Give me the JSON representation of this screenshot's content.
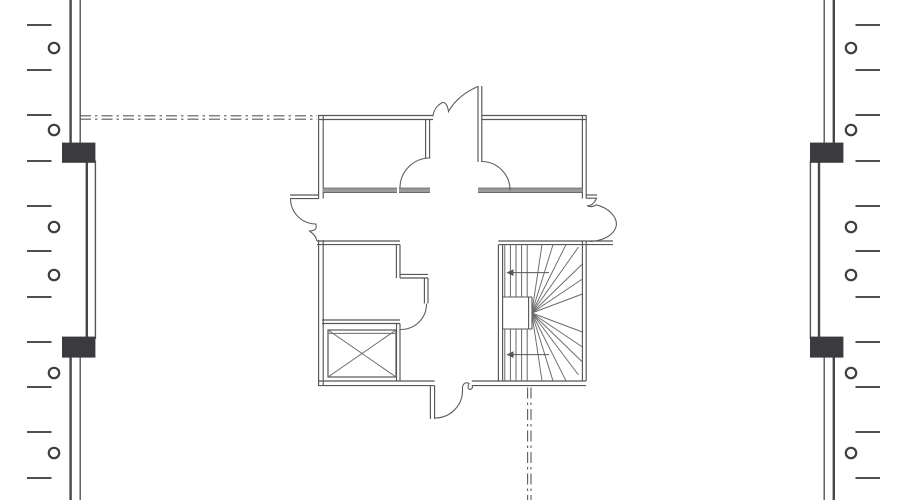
{
  "page": {
    "background": "#ffffff"
  },
  "colors": {
    "line": "#565656",
    "line_soft": "#6a6a6a",
    "thick_line": "#474747",
    "dark_block": "#3b3b3f",
    "wall_bar": "#9a9a9a"
  },
  "drawing": {
    "canvas": {
      "w": 900,
      "h": 500
    },
    "curtain_walls": [
      {
        "name": "left-curtain-wall",
        "segments": [
          {
            "xa": 70.6,
            "xb": 80.2,
            "y1": 0,
            "y2": 146
          },
          {
            "xa": 86.8,
            "xb": 95.4,
            "y1": 160.5,
            "y2": 339
          },
          {
            "xa": 70.6,
            "xb": 80.2,
            "y1": 356,
            "y2": 500
          }
        ],
        "blocks": [
          {
            "x": 62,
            "y": 142.6,
            "w": 33.4,
            "h": 20.2
          },
          {
            "x": 62,
            "y": 336.6,
            "w": 33.4,
            "h": 21
          }
        ],
        "ticks": {
          "x1": 27,
          "x2": 51.5,
          "ys": [
            25,
            70,
            115,
            161,
            206,
            251,
            297,
            342,
            387,
            432,
            478
          ]
        },
        "circles": {
          "cx": 54,
          "r": 5.2,
          "cys": [
            48,
            130,
            227,
            275,
            373,
            453
          ]
        }
      },
      {
        "name": "right-curtain-wall",
        "segments": [
          {
            "xa": 833.8,
            "xb": 824.2,
            "y1": 0,
            "y2": 146
          },
          {
            "xa": 819,
            "xb": 810.4,
            "y1": 160.5,
            "y2": 339
          },
          {
            "xa": 833.8,
            "xb": 824.2,
            "y1": 356,
            "y2": 500
          }
        ],
        "blocks": [
          {
            "x": 810,
            "y": 142.6,
            "w": 33.4,
            "h": 20.2
          },
          {
            "x": 810,
            "y": 336.6,
            "w": 33.4,
            "h": 21
          }
        ],
        "ticks": {
          "x1": 855.5,
          "x2": 880,
          "ys": [
            25,
            70,
            115,
            161,
            206,
            251,
            297,
            342,
            387,
            432,
            478
          ]
        },
        "circles": {
          "cx": 851,
          "r": 5.2,
          "cys": [
            48,
            130,
            227,
            275,
            373,
            453
          ]
        }
      }
    ],
    "centerlines": [
      {
        "name": "grid-centerline-horizontal",
        "o": "h",
        "c1": 115.8,
        "c2": 119.2,
        "from": 80,
        "to": 317,
        "dash": "11 4 2.5 4"
      },
      {
        "name": "grid-centerline-vertical",
        "o": "v",
        "c1": 527.6,
        "c2": 531,
        "from": 387.5,
        "to": 500,
        "dash": "11 4 2.5 4"
      }
    ],
    "double_walls": [
      {
        "n": "upper-left-room-top-wall",
        "x1": 318,
        "y1": 115.5,
        "x2": 433,
        "y2": 115.5,
        "o": 4,
        "d": "h"
      },
      {
        "n": "upper-left-room-left-wall",
        "x1": 318.6,
        "y1": 115,
        "x2": 318.6,
        "y2": 198.5,
        "o": 4.6,
        "d": "v"
      },
      {
        "n": "upper-left-room-right-wall",
        "x1": 425.6,
        "y1": 119.5,
        "x2": 425.6,
        "y2": 158,
        "o": 4,
        "d": "v"
      },
      {
        "n": "upper-right-room-left-wall",
        "x1": 478,
        "y1": 86,
        "x2": 478,
        "y2": 162,
        "o": 3.8,
        "d": "v"
      },
      {
        "n": "upper-right-room-top-wall",
        "x1": 481.8,
        "y1": 115.5,
        "x2": 586,
        "y2": 115.5,
        "o": 4,
        "d": "h"
      },
      {
        "n": "upper-right-room-right-wall",
        "x1": 582.4,
        "y1": 115,
        "x2": 582.4,
        "y2": 198.5,
        "o": 3.8,
        "d": "v"
      },
      {
        "n": "corridor-left-wall",
        "x1": 290,
        "y1": 195,
        "x2": 319,
        "y2": 195,
        "o": 3.6,
        "d": "h"
      },
      {
        "n": "corridor-right-jamb",
        "x1": 586,
        "y1": 195,
        "x2": 597,
        "y2": 195,
        "o": 3.2,
        "d": "h"
      },
      {
        "n": "stair-lobby-top-wall",
        "x1": 498.4,
        "y1": 241,
        "x2": 613,
        "y2": 241,
        "o": 3.6,
        "d": "h"
      },
      {
        "n": "lower-left-room-top-wall",
        "x1": 317,
        "y1": 241,
        "x2": 400,
        "y2": 241,
        "o": 3.6,
        "d": "h"
      },
      {
        "n": "lower-left-room-left-wall",
        "x1": 318.6,
        "y1": 240,
        "x2": 318.6,
        "y2": 385.8,
        "o": 4.6,
        "d": "v"
      },
      {
        "n": "lower-left-room-right-wall",
        "x1": 396.4,
        "y1": 244.6,
        "x2": 396.4,
        "y2": 278,
        "o": 3.6,
        "d": "v"
      },
      {
        "n": "closet-step-wall-horizontal",
        "x1": 400,
        "y1": 274.4,
        "x2": 428,
        "y2": 274.4,
        "o": 3.6,
        "d": "h"
      },
      {
        "n": "closet-step-wall-vertical",
        "x1": 424.4,
        "y1": 278,
        "x2": 424.4,
        "y2": 303.5,
        "o": 3.6,
        "d": "v"
      },
      {
        "n": "shaft-top-wall",
        "x1": 322,
        "y1": 320,
        "x2": 400,
        "y2": 320,
        "o": 3.5,
        "d": "h"
      },
      {
        "n": "shaft-right-wall",
        "x1": 396.5,
        "y1": 323.5,
        "x2": 396.5,
        "y2": 381,
        "o": 3.5,
        "d": "v"
      },
      {
        "n": "bottom-wall-left",
        "x1": 318,
        "y1": 381,
        "x2": 434.6,
        "y2": 381,
        "o": 4.6,
        "d": "h"
      },
      {
        "n": "exit-door-jamb",
        "x1": 430.4,
        "y1": 385.6,
        "x2": 430.4,
        "y2": 419,
        "o": 4.2,
        "d": "v"
      },
      {
        "n": "bottom-wall-right",
        "x1": 471.8,
        "y1": 381,
        "x2": 586,
        "y2": 381,
        "o": 4.6,
        "d": "h"
      },
      {
        "n": "stair-left-wall",
        "x1": 498.4,
        "y1": 244.6,
        "x2": 498.4,
        "y2": 381,
        "o": 4.2,
        "d": "v"
      },
      {
        "n": "stair-right-wall",
        "x1": 582.4,
        "y1": 241,
        "x2": 582.4,
        "y2": 381,
        "o": 3.8,
        "d": "v"
      }
    ],
    "wall_bars": [
      {
        "n": "upper-left-room-bottom-wall-a",
        "x1": 322.8,
        "x2": 397,
        "y": 190.3
      },
      {
        "n": "upper-left-room-bottom-wall-b",
        "x1": 399,
        "x2": 430,
        "y": 190.3
      },
      {
        "n": "upper-right-room-bottom-wall",
        "x1": 478,
        "x2": 582.4,
        "y": 190.3
      }
    ],
    "door_arcs": [
      {
        "n": "door-swing-upper-left-room",
        "cx": 430,
        "cy": 188,
        "r": 30,
        "a1": 180,
        "a2": 270,
        "sweep": 1
      },
      {
        "n": "door-swing-upper-right-room",
        "cx": 481.5,
        "cy": 190,
        "r": 28.5,
        "a1": 270,
        "a2": 360,
        "sweep": 1
      },
      {
        "n": "door-swing-corridor-left",
        "cx": 316,
        "cy": 198.5,
        "r": 25.5,
        "a1": 180,
        "a2": 90,
        "sweep": 0
      },
      {
        "n": "door-swing-lower-left-room",
        "cx": 401,
        "cy": 304,
        "r": 25.5,
        "a1": 0,
        "a2": 90,
        "sweep": 1
      },
      {
        "n": "door-swing-bottom-exit",
        "cx": 435,
        "cy": 390.5,
        "r": 27.5,
        "a1": 90,
        "a2": 0,
        "sweep": 0
      }
    ],
    "squiggles": [
      {
        "n": "vestibule-door-leaf",
        "d": "M 478,86.5 C 467,91 455,99.5 448.5,111.5 C 447.5,104.5 444.5,101 441.5,103 C 436.5,106 433.5,111 433,116"
      },
      {
        "n": "corridor-left-door-leaf-tip",
        "d": "M 315.8,224 C 317.6,230.5 313,230.5 309.6,231 C 313,233.5 316.4,236.5 316.6,240.5"
      },
      {
        "n": "corridor-right-door-leaf",
        "d": "M 596.5,198.2 C 594.5,203.5 590.5,206.2 587,205.8 C 590.5,207.4 594,206.4 596.2,204.8 C 608.5,207.8 617.2,216.8 616.4,225.2 C 614.8,234.8 603.8,240.6 590.5,241.4"
      },
      {
        "n": "exit-door-leaf-tip",
        "d": "M 462.6,390.2 C 461.6,384.4 465.6,381 469,383.6 C 466.6,388 469.6,391.6 472.4,387.8 L 472.4,385.4"
      }
    ],
    "shaft": {
      "name": "elevator-shaft",
      "x": 328,
      "y": 330,
      "w": 68,
      "h": 47,
      "inner_top": 3.4
    },
    "stairs": {
      "name": "switchback-stair",
      "tread_xs": [
        504.8,
        510.4,
        516,
        521.6,
        527.2
      ],
      "upper_flight": {
        "y1": 244.6,
        "y2": 297
      },
      "lower_flight": {
        "y1": 329,
        "y2": 381
      },
      "flight_edges": [
        {
          "x1": 502.6,
          "y1": 297,
          "x2": 532,
          "y2": 297
        },
        {
          "x1": 502.6,
          "y1": 329,
          "x2": 532,
          "y2": 329
        }
      ],
      "well_lines": [
        {
          "x": 528.6,
          "y1": 297,
          "y2": 329
        },
        {
          "x": 532,
          "y1": 297,
          "y2": 329
        }
      ],
      "fan_center": {
        "x": 531.8,
        "y": 313
      },
      "fan_points": [
        [
          542,
          244.6
        ],
        [
          553,
          244.6
        ],
        [
          566,
          244.6
        ],
        [
          578.5,
          247
        ],
        [
          582.4,
          264
        ],
        [
          582.4,
          279
        ],
        [
          582.4,
          294
        ],
        [
          582.4,
          332
        ],
        [
          582.4,
          347
        ],
        [
          582.4,
          362
        ],
        [
          578.5,
          375
        ],
        [
          566,
          380.8
        ],
        [
          553,
          380.8
        ],
        [
          542,
          380.8
        ]
      ],
      "arrows": [
        {
          "x1": 549,
          "y1": 272.6,
          "x2": 506.5,
          "y2": 272.6
        },
        {
          "x1": 549,
          "y1": 354.6,
          "x2": 506.5,
          "y2": 354.6
        }
      ]
    }
  }
}
